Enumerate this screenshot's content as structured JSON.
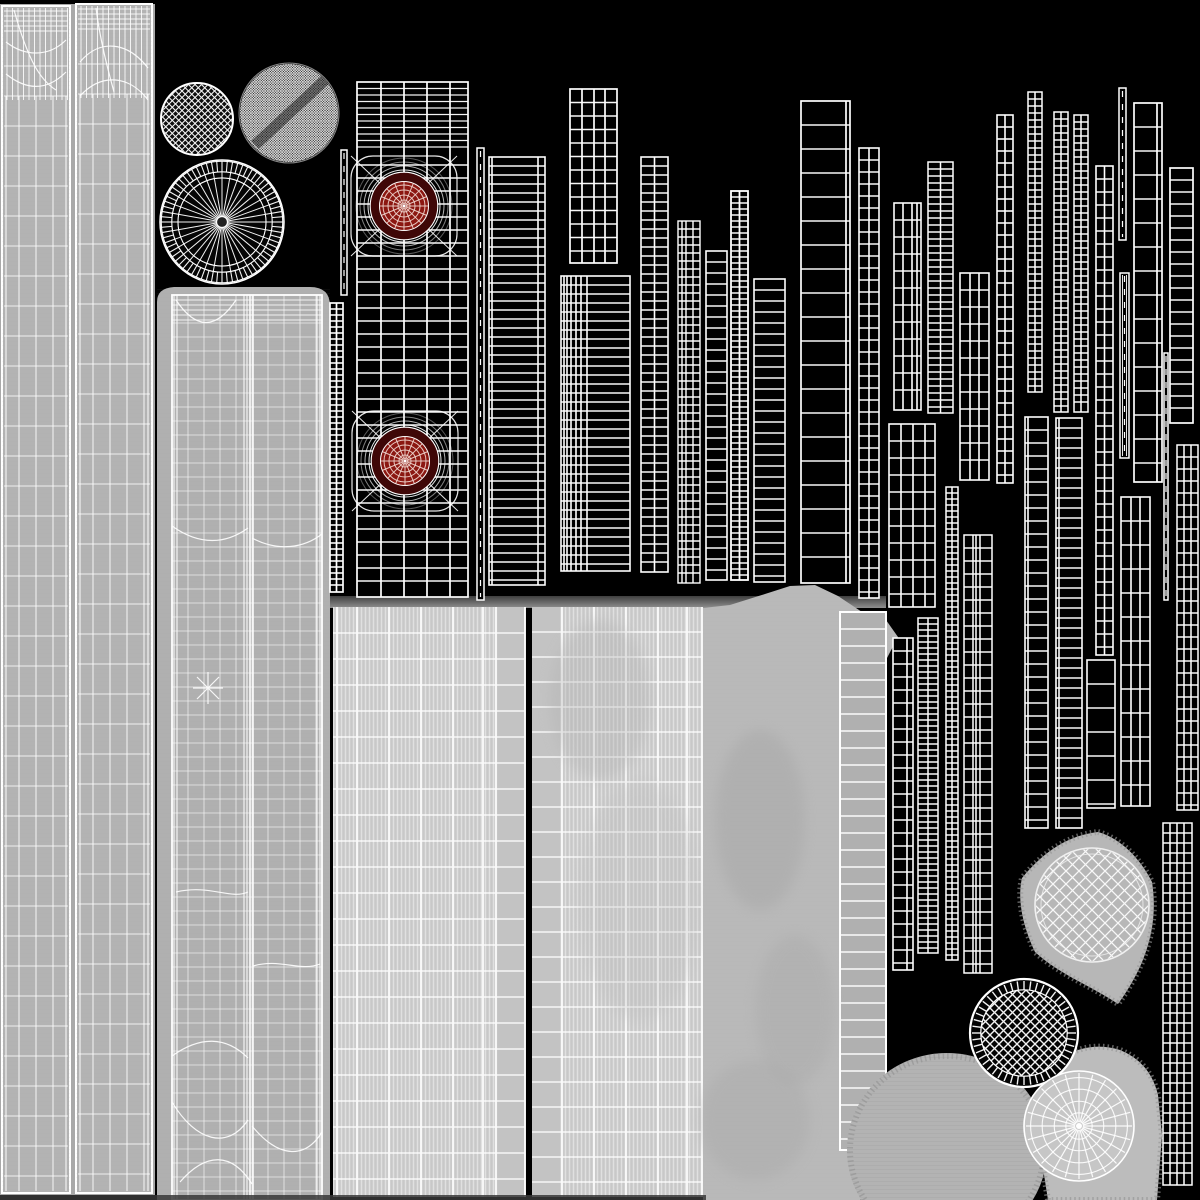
{
  "meta": {
    "title": "uv-wireframe-texture-atlas",
    "canvas": {
      "w": 1200,
      "h": 1200
    },
    "background": "#000000"
  },
  "palette": {
    "background": "#000000",
    "wire": "#ffffff",
    "fabric_base": "#b3b3b3",
    "fabric_backing": "#a9a9a9",
    "leg_base": "#b0b0b0",
    "knit_base": "#c8c8c8",
    "knit_plain": "#c3c3c3",
    "smooth_column": "#b9b9b9",
    "blob_gray": "#b7b7b7",
    "shadow_dark": "#3f3f3f",
    "shadow_light": "#8f8f8f",
    "bottom_band": "#383838",
    "target_red": "#8b1711",
    "target_dark_ring": "#3f0707",
    "target_web": "#f0d6cf"
  },
  "atlas": {
    "shadow_band": {
      "name": "gray-area-top-shadow",
      "x": 327,
      "y": 596,
      "w": 559,
      "h": 12
    },
    "bottom_band": {
      "name": "bottom-shadow-band",
      "x": 0,
      "y": 1195,
      "w": 706,
      "h": 5,
      "fill": "#383838"
    },
    "fabric": [
      {
        "type": "backing",
        "name": "pants-uv-backing",
        "x": 0,
        "y": 4,
        "w": 155,
        "h": 1191,
        "fill": "#a9a9a9"
      },
      {
        "type": "pant_panel",
        "name": "pants-uv-panel-left",
        "x": 2,
        "y": 6,
        "w": 68,
        "h": 1187,
        "fill": "#b3b3b3",
        "curves": [
          "M6,42 C24,56 48,58 66,40",
          "M6,74 C26,90 46,92 66,72",
          "M14,10 C28,60 40,80 56,90"
        ]
      },
      {
        "type": "pant_panel",
        "name": "pants-uv-panel-right",
        "x": 76,
        "y": 4,
        "w": 76,
        "h": 1189,
        "fill": "#b3b3b3",
        "curves": [
          "M80,62 C100,38 128,42 148,68",
          "M80,96 C102,72 130,76 148,100",
          "M96,8 C100,40 108,70 114,92"
        ]
      },
      {
        "type": "leg_panel",
        "name": "leg-uv-panel",
        "x": 157,
        "y": 287,
        "w": 173,
        "h": 913,
        "bg": "M157,1200 V302 Q157,288 174,287 H310 Q330,287 330,306 V1200 Z",
        "mesh": {
          "x": 172,
          "y": 295,
          "w": 150,
          "h": 905
        },
        "seam_x": 250,
        "clusters": [
          174,
          177,
          244,
          247,
          317,
          320
        ],
        "curves": [
          "M176,300 C196,330 216,330 236,300",
          "M172,526 C200,546 226,544 248,528",
          "M252,538 C278,552 304,548 322,534",
          "M208,672 L208,704 M193,688 L223,688 M197,677 L219,699 M197,699 L219,677",
          "M176,892 C210,884 230,900 248,892",
          "M253,966 C280,958 300,972 320,964",
          "M172,1056 C200,1036 226,1036 248,1058",
          "M172,1102 C196,1142 228,1150 248,1120",
          "M252,1126 C280,1160 306,1158 322,1132",
          "M180,1182 C206,1152 232,1152 252,1184"
        ]
      },
      {
        "type": "knit_panel",
        "name": "fabric-panel-bottom-left",
        "x": 333,
        "y": 607,
        "w": 192,
        "h": 590,
        "stripe_from": 0,
        "stripe_to": 164,
        "plain_from": 164,
        "plain_to": 192,
        "hstep": 26,
        "bright": [
          4,
          24,
          56,
          88,
          120,
          150,
          163
        ],
        "right_border": true
      },
      {
        "type": "knit_panel",
        "name": "fabric-panel-bottom-mid",
        "x": 532,
        "y": 607,
        "w": 171,
        "h": 590,
        "stripe_from": 28,
        "stripe_to": 171,
        "plain_from": 0,
        "plain_to": 28,
        "hstep": 25,
        "bright": [
          30,
          62,
          94,
          126,
          155,
          170
        ],
        "right_border": false
      },
      {
        "type": "path",
        "name": "smooth-fabric-column",
        "d": "M703,1200 H860 L874,1196 L886,1150 L887,658 L898,637 L886,620 L862,612 L838,596 L815,585 L790,586 L765,594 L730,605 L703,608 Z",
        "fill": "#b9b9b9"
      },
      {
        "type": "gray_ladder",
        "name": "fabric-strap-ladder",
        "x": 840,
        "y": 612,
        "w": 46,
        "h": 538,
        "rs": 17,
        "fill": "#b0b0b0"
      },
      {
        "type": "blob",
        "name": "glove-uv-blob",
        "d": "M1098,832 C1120,838 1140,858 1152,882 C1158,920 1150,960 1118,1004 C1090,985 1060,975 1035,952 C1020,920 1018,895 1022,878 C1045,850 1070,835 1098,832 Z",
        "fill": "#b7b7b7",
        "fringe": true
      },
      {
        "type": "blob",
        "name": "round-fabric-blob",
        "ellipse": [
          947,
          1150,
          100,
          97
        ],
        "fill": "#b3b3b3",
        "striations": true,
        "fringe": true
      },
      {
        "type": "blob",
        "name": "cuff-uv-blob",
        "d": "M1048,1200 L1037,1130 Q1035,1085 1058,1060 Q1088,1040 1120,1050 Q1150,1062 1158,1095 L1162,1135 L1157,1200 Z",
        "fill": "#bcbcbc",
        "fringe": true
      }
    ],
    "mottle": [
      {
        "x": 760,
        "y": 820,
        "rx": 45,
        "ry": 90,
        "f": "#a6a6a6",
        "o": 0.45
      },
      {
        "x": 795,
        "y": 1010,
        "rx": 40,
        "ry": 75,
        "f": "#a9a9a9",
        "o": 0.4
      },
      {
        "x": 755,
        "y": 1120,
        "rx": 55,
        "ry": 60,
        "f": "#a6a6a6",
        "o": 0.35
      },
      {
        "x": 640,
        "y": 900,
        "rx": 60,
        "ry": 120,
        "f": "#bdbdbd",
        "o": 0.3
      },
      {
        "x": 600,
        "y": 700,
        "rx": 50,
        "ry": 80,
        "f": "#b0b0b0",
        "o": 0.35
      }
    ],
    "wire_strips": [
      {
        "type": "ladder",
        "name": "jacket-main-panel",
        "x": 357,
        "y": 82,
        "w": 111,
        "h": 515,
        "cols": [
          0,
          24,
          47,
          70,
          93,
          111
        ],
        "rs": 13,
        "sw": 1.7,
        "dt": {
          "h": 70,
          "step": 6.5
        }
      },
      {
        "type": "thin",
        "name": "uv-strip-b",
        "x": 341,
        "y": 150,
        "w": 6,
        "h": 145
      },
      {
        "type": "ladder",
        "name": "uv-strip-c",
        "x": 330,
        "y": 303,
        "w": 13,
        "h": 289,
        "cols": [
          0,
          6.5,
          13
        ],
        "rs": 6,
        "sw": 1.7
      },
      {
        "type": "thin",
        "name": "uv-strip-d",
        "x": 477,
        "y": 148,
        "w": 7,
        "h": 452
      },
      {
        "type": "ladder",
        "name": "uv-strip-e",
        "x": 489,
        "y": 157,
        "w": 56,
        "h": 428,
        "cols": [
          0,
          3,
          49,
          56
        ],
        "rs": 9,
        "sw": 1.6
      },
      {
        "type": "ladder",
        "name": "uv-grid-f",
        "x": 570,
        "y": 89,
        "w": 47,
        "h": 174,
        "cols": [
          0,
          12,
          24,
          35,
          47
        ],
        "rs": 13.5,
        "sw": 1.7
      },
      {
        "type": "ladder",
        "name": "uv-panel-g",
        "x": 561,
        "y": 276,
        "w": 69,
        "h": 295,
        "cols": [
          0,
          3,
          6,
          10,
          15,
          20,
          26,
          69
        ],
        "rs": 9,
        "sw": 1.6
      },
      {
        "type": "ladder",
        "name": "uv-strip-h",
        "x": 641,
        "y": 157,
        "w": 27,
        "h": 415,
        "cols": [
          0,
          13.5,
          27
        ],
        "rs": 9,
        "sw": 1.6
      },
      {
        "type": "ladder",
        "name": "uv-strip-i",
        "x": 678,
        "y": 221,
        "w": 22,
        "h": 362,
        "cols": [
          0,
          4,
          8,
          15,
          22
        ],
        "rs": 8,
        "sw": 1.4
      },
      {
        "type": "ladder",
        "name": "uv-strip-j",
        "x": 706,
        "y": 251,
        "w": 21,
        "h": 329,
        "cols": [
          0,
          21
        ],
        "rs": 11,
        "sw": 1.6
      },
      {
        "type": "ladder",
        "name": "uv-strip-k",
        "x": 731,
        "y": 191,
        "w": 17,
        "h": 389,
        "cols": [
          0,
          8.5,
          17
        ],
        "rs": 6,
        "sw": 1.8
      },
      {
        "type": "ladder",
        "name": "uv-strip-l",
        "x": 754,
        "y": 279,
        "w": 31,
        "h": 303,
        "cols": [
          0,
          31
        ],
        "rs": 11,
        "sw": 1.6
      },
      {
        "type": "ladder",
        "name": "uv-strip-m",
        "x": 801,
        "y": 101,
        "w": 49,
        "h": 482,
        "cols": [
          0,
          45,
          49
        ],
        "rs": 24,
        "sw": 1.7
      },
      {
        "type": "ladder",
        "name": "uv-strip-n",
        "x": 859,
        "y": 148,
        "w": 20,
        "h": 450,
        "cols": [
          0,
          10,
          20
        ],
        "rs": 12,
        "sw": 1.6
      },
      {
        "type": "ladder",
        "name": "uv-grid-o",
        "x": 894,
        "y": 203,
        "w": 27,
        "h": 207,
        "cols": [
          0,
          9,
          18,
          23,
          27
        ],
        "rs": 17,
        "sw": 1.6
      },
      {
        "type": "ladder",
        "name": "uv-grid-p",
        "x": 889,
        "y": 424,
        "w": 46,
        "h": 183,
        "cols": [
          0,
          12,
          24,
          36,
          46
        ],
        "rs": 17,
        "sw": 1.6
      },
      {
        "type": "ladder",
        "name": "uv-strip-q",
        "x": 928,
        "y": 162,
        "w": 25,
        "h": 251,
        "cols": [
          0,
          12.5,
          25
        ],
        "rs": 7,
        "sw": 1.5
      },
      {
        "type": "ladder",
        "name": "uv-strip-r",
        "x": 946,
        "y": 487,
        "w": 12,
        "h": 473,
        "cols": [
          0,
          6,
          12
        ],
        "rs": 6,
        "sw": 1.5
      },
      {
        "type": "ladder",
        "name": "uv-grid-s",
        "x": 960,
        "y": 273,
        "w": 29,
        "h": 207,
        "cols": [
          0,
          10,
          19,
          29
        ],
        "rs": 17,
        "sw": 1.6
      },
      {
        "type": "ladder",
        "name": "uv-strip-t",
        "x": 964,
        "y": 535,
        "w": 28,
        "h": 438,
        "cols": [
          0,
          9,
          12,
          16,
          28
        ],
        "rs": 13,
        "sw": 1.5
      },
      {
        "type": "ladder",
        "name": "uv-strip-u",
        "x": 997,
        "y": 115,
        "w": 16,
        "h": 368,
        "cols": [
          0,
          8,
          16
        ],
        "rs": 12,
        "sw": 1.6
      },
      {
        "type": "ladder",
        "name": "uv-strip-v",
        "x": 1028,
        "y": 92,
        "w": 14,
        "h": 300,
        "cols": [
          0,
          7,
          14
        ],
        "rs": 7,
        "sw": 1.5
      },
      {
        "type": "ladder",
        "name": "uv-strip-w",
        "x": 1025,
        "y": 417,
        "w": 23,
        "h": 411,
        "cols": [
          0,
          3,
          23
        ],
        "rs": 13,
        "sw": 1.6
      },
      {
        "type": "ladder",
        "name": "uv-strip-x",
        "x": 1054,
        "y": 112,
        "w": 14,
        "h": 300,
        "cols": [
          0,
          7,
          14
        ],
        "rs": 7,
        "sw": 1.5
      },
      {
        "type": "ladder",
        "name": "uv-strip-y",
        "x": 1056,
        "y": 418,
        "w": 26,
        "h": 410,
        "cols": [
          0,
          3,
          26
        ],
        "rs": 10,
        "sw": 1.6
      },
      {
        "type": "ladder",
        "name": "uv-strip-z",
        "x": 1074,
        "y": 115,
        "w": 14,
        "h": 297,
        "cols": [
          0,
          7,
          14
        ],
        "rs": 7,
        "sw": 1.5
      },
      {
        "type": "ladder",
        "name": "uv-strip-aa",
        "x": 1096,
        "y": 166,
        "w": 17,
        "h": 489,
        "cols": [
          0,
          8.5,
          17
        ],
        "rs": 13,
        "sw": 1.6
      },
      {
        "type": "ladder",
        "name": "uv-strip-ab",
        "x": 1087,
        "y": 660,
        "w": 28,
        "h": 148,
        "cols": [
          0,
          28
        ],
        "rs": 24,
        "sw": 1.6
      },
      {
        "type": "thin",
        "name": "uv-strip-ac",
        "x": 1119,
        "y": 88,
        "w": 7,
        "h": 152
      },
      {
        "type": "thin",
        "name": "uv-strip-ad",
        "x": 1120,
        "y": 273,
        "w": 9,
        "h": 185,
        "inner2": true
      },
      {
        "type": "ladder",
        "name": "uv-strip-ae",
        "x": 1134,
        "y": 103,
        "w": 28,
        "h": 379,
        "cols": [
          0,
          23,
          28
        ],
        "rs": 24,
        "sw": 1.7
      },
      {
        "type": "ladder",
        "name": "uv-strip-af",
        "x": 1170,
        "y": 168,
        "w": 23,
        "h": 255,
        "cols": [
          0,
          23
        ],
        "rs": 12,
        "sw": 1.7
      },
      {
        "type": "thin",
        "name": "uv-strip-ag",
        "x": 1164,
        "y": 353,
        "w": 4,
        "h": 247
      },
      {
        "type": "ladder",
        "name": "uv-grid-ah",
        "x": 1121,
        "y": 497,
        "w": 29,
        "h": 309,
        "cols": [
          0,
          10,
          19,
          29
        ],
        "rs": 24,
        "sw": 1.6
      },
      {
        "type": "ladder",
        "name": "uv-grid-ai",
        "x": 1177,
        "y": 445,
        "w": 21,
        "h": 365,
        "cols": [
          0,
          7,
          14,
          21
        ],
        "rs": 12,
        "sw": 1.5
      },
      {
        "type": "ladder",
        "name": "uv-strip-aj",
        "x": 893,
        "y": 638,
        "w": 20,
        "h": 332,
        "cols": [
          0,
          14,
          20
        ],
        "rs": 13,
        "sw": 1.6
      },
      {
        "type": "ladder",
        "name": "uv-strip-ak",
        "x": 918,
        "y": 618,
        "w": 20,
        "h": 335,
        "cols": [
          0,
          10,
          20
        ],
        "rs": 6,
        "sw": 1.5
      },
      {
        "type": "ladder",
        "name": "uv-grid-al",
        "x": 1163,
        "y": 823,
        "w": 29,
        "h": 362,
        "cols": [
          0,
          7,
          14,
          21,
          29
        ],
        "rs": 10,
        "sw": 1.5
      }
    ],
    "features": [
      {
        "kind": "crosshatch",
        "name": "cap-crosshatch-circle",
        "cx": 197,
        "cy": 119,
        "r": 36,
        "spacing": 6.5
      },
      {
        "kind": "moire",
        "name": "cap-moire-circle",
        "cx": 289,
        "cy": 113,
        "r": 50,
        "spacing": 2.6
      },
      {
        "kind": "wheel_dark",
        "name": "sole-radial-wheel",
        "cx": 222,
        "cy": 222,
        "r": 62
      },
      {
        "kind": "crosshatch_ring",
        "name": "heel-crosshatch-circle",
        "cx": 1024,
        "cy": 1033,
        "r": 54,
        "spacing": 9
      },
      {
        "kind": "wheel_light",
        "name": "cuff-radial-wheel",
        "cx": 1079,
        "cy": 1126,
        "r": 55
      },
      {
        "kind": "sphere",
        "name": "sphere-wireframe",
        "cx": 1092,
        "cy": 905,
        "r": 57,
        "spacing": 13
      }
    ],
    "red_targets": [
      {
        "name": "speaker-target-top",
        "cx": 404,
        "cy": 206,
        "r": 24.5
      },
      {
        "name": "speaker-target-bottom",
        "cx": 405,
        "cy": 461,
        "r": 24.5
      }
    ]
  }
}
